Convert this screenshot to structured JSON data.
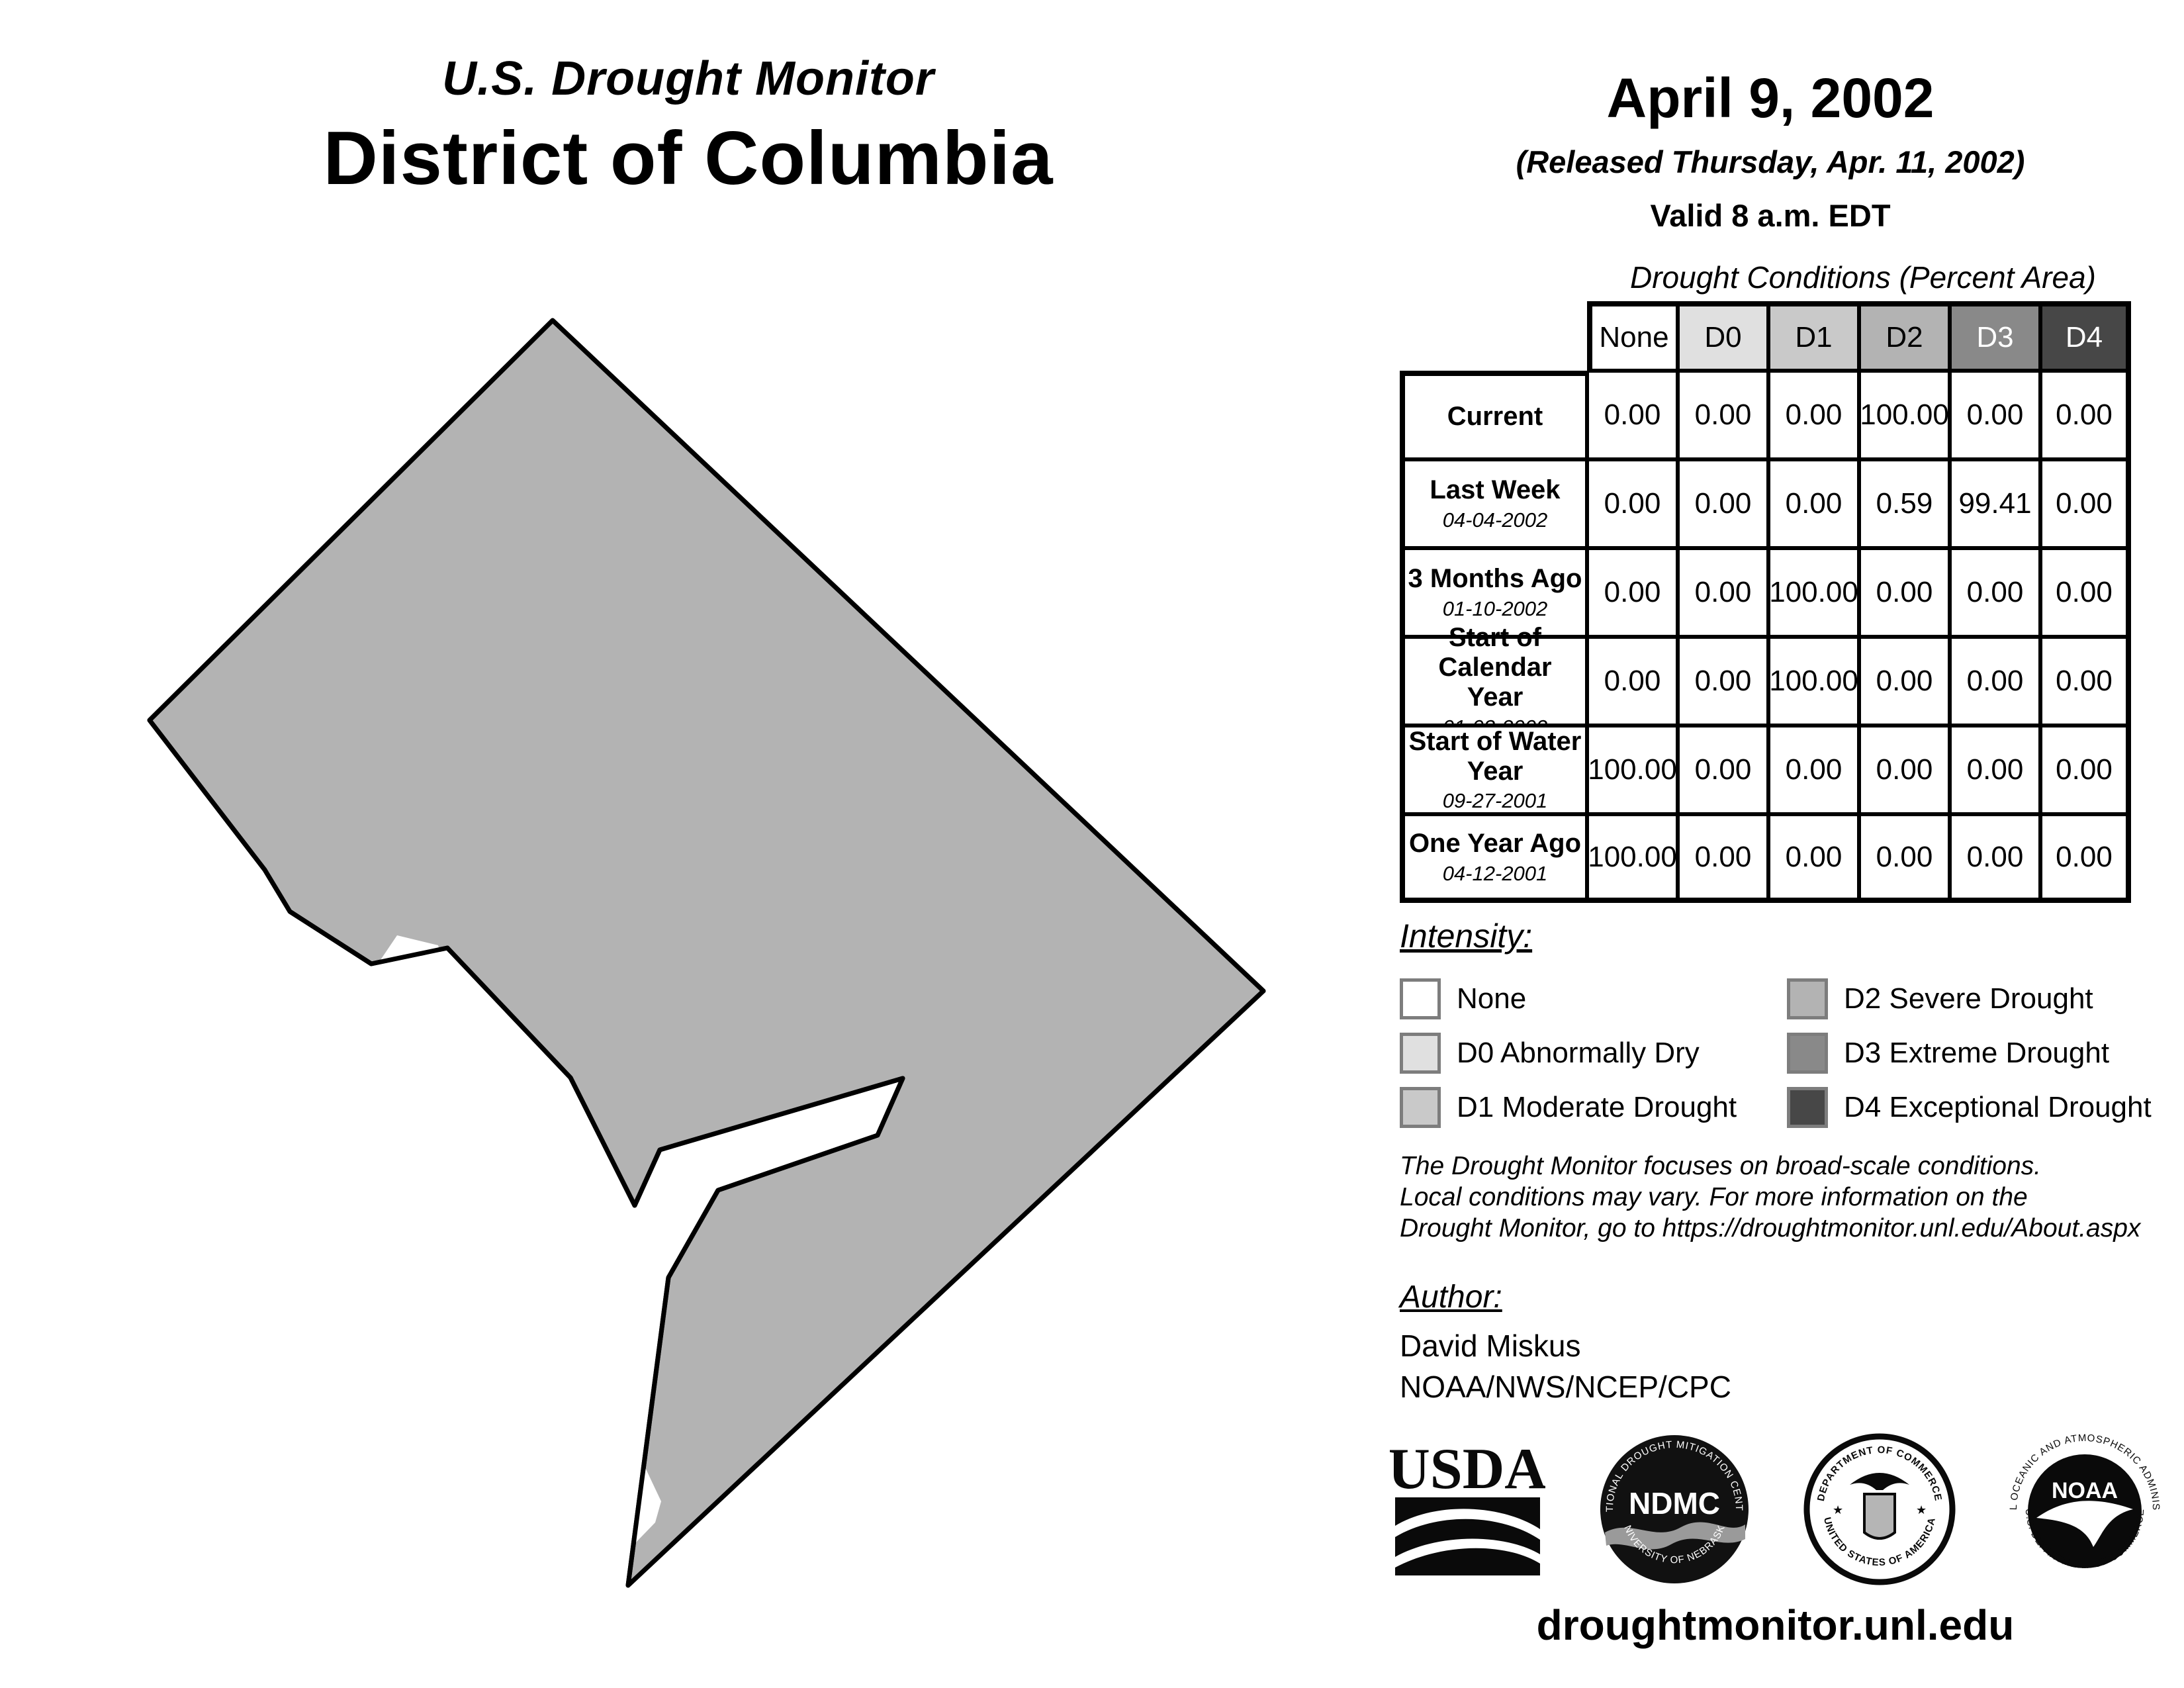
{
  "page": {
    "title_line1": "U.S. Drought Monitor",
    "title_line2": "District of Columbia",
    "date": "April 9, 2002",
    "released": "(Released Thursday, Apr. 11, 2002)",
    "valid": "Valid 8 a.m. EDT",
    "footer_url": "droughtmonitor.unl.edu"
  },
  "colors": {
    "none": "#ffffff",
    "d0": "#e0e0e0",
    "d1": "#c9c9c9",
    "d2": "#b3b3b3",
    "d3": "#898989",
    "d4": "#474747",
    "map_fill": "#b3b3b3",
    "map_outline": "#000000",
    "water": "#ffffff"
  },
  "chart_data": {
    "type": "table",
    "title": "Drought Conditions (Percent Area)",
    "columns": [
      "None",
      "D0",
      "D1",
      "D2",
      "D3",
      "D4"
    ],
    "rows": [
      {
        "label": "Current",
        "date": "",
        "values": [
          "0.00",
          "0.00",
          "0.00",
          "100.00",
          "0.00",
          "0.00"
        ]
      },
      {
        "label": "Last Week",
        "date": "04-04-2002",
        "values": [
          "0.00",
          "0.00",
          "0.00",
          "0.59",
          "99.41",
          "0.00"
        ]
      },
      {
        "label": "3 Months Ago",
        "date": "01-10-2002",
        "values": [
          "0.00",
          "0.00",
          "100.00",
          "0.00",
          "0.00",
          "0.00"
        ]
      },
      {
        "label": "Start of Calendar Year",
        "date": "01-03-2002",
        "values": [
          "0.00",
          "0.00",
          "100.00",
          "0.00",
          "0.00",
          "0.00"
        ]
      },
      {
        "label": "Start of Water Year",
        "date": "09-27-2001",
        "values": [
          "100.00",
          "0.00",
          "0.00",
          "0.00",
          "0.00",
          "0.00"
        ]
      },
      {
        "label": "One Year Ago",
        "date": "04-12-2001",
        "values": [
          "100.00",
          "0.00",
          "0.00",
          "0.00",
          "0.00",
          "0.00"
        ]
      }
    ]
  },
  "legend": {
    "title": "Intensity:",
    "items": [
      {
        "label": "None",
        "color": "#ffffff"
      },
      {
        "label": "D0 Abnormally Dry",
        "color": "#e0e0e0"
      },
      {
        "label": "D1 Moderate Drought",
        "color": "#c9c9c9"
      },
      {
        "label": "D2 Severe Drought",
        "color": "#b3b3b3"
      },
      {
        "label": "D3 Extreme Drought",
        "color": "#898989"
      },
      {
        "label": "D4 Exceptional Drought",
        "color": "#474747"
      }
    ]
  },
  "disclaimer": {
    "line1": "The Drought Monitor focuses on broad-scale conditions.",
    "line2": "Local conditions may vary. For more information on the",
    "line3": "Drought Monitor, go to https://droughtmonitor.unl.edu/About.aspx"
  },
  "author": {
    "title": "Author:",
    "name": "David Miskus",
    "org": "NOAA/NWS/NCEP/CPC"
  },
  "logos": {
    "usda_text": "USDA",
    "ndmc_center": "NDMC",
    "ndmc_top": "NATIONAL DROUGHT MITIGATION CENTER",
    "ndmc_bottom": "UNIVERSITY OF NEBRASKA",
    "doc_top": "DEPARTMENT OF COMMERCE",
    "doc_bottom": "UNITED STATES OF AMERICA",
    "noaa_center": "NOAA",
    "noaa_top": "NATIONAL OCEANIC AND ATMOSPHERIC ADMINISTRATION",
    "noaa_bottom": "U.S. DEPARTMENT OF COMMERCE"
  }
}
